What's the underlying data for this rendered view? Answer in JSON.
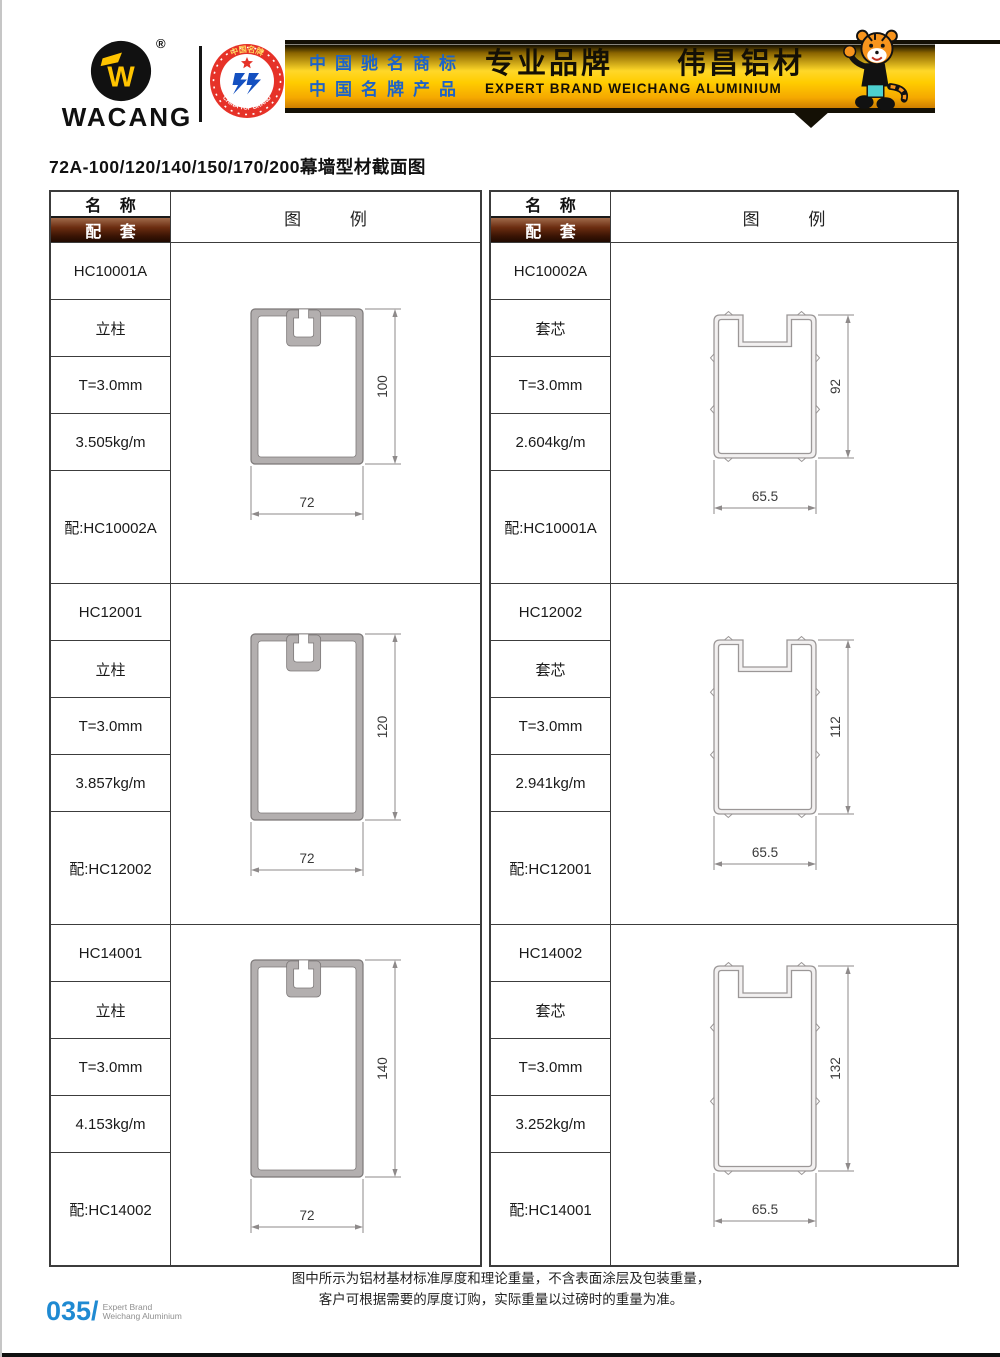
{
  "header": {
    "logo_text": "WACANG",
    "registered_mark": "®",
    "badge": {
      "arc_top": "中国名牌",
      "arc_bottom": "CHINA TOP BRAND"
    },
    "banner": {
      "left_line1": "中国驰名商标",
      "left_line2": "中国名牌产品",
      "right_title": "专业品牌　　伟昌铝材",
      "right_subtitle": "EXPERT BRAND WEICHANG ALUMINIUM"
    }
  },
  "page_title": "72A-100/120/140/150/170/200幕墙型材截面图",
  "table": {
    "header": {
      "name_label": "名 称",
      "match_label": "配 套",
      "legend_label": "图 例"
    },
    "left_sections": [
      {
        "code": "HC10001A",
        "type": "立柱",
        "thickness": "T=3.0mm",
        "weight": "3.505kg/m",
        "match": "配:HC10002A",
        "width_mm": 72,
        "height_mm": 100,
        "width_label": "72",
        "height_label": "100"
      },
      {
        "code": "HC12001",
        "type": "立柱",
        "thickness": "T=3.0mm",
        "weight": "3.857kg/m",
        "match": "配:HC12002",
        "width_mm": 72,
        "height_mm": 120,
        "width_label": "72",
        "height_label": "120"
      },
      {
        "code": "HC14001",
        "type": "立柱",
        "thickness": "T=3.0mm",
        "weight": "4.153kg/m",
        "match": "配:HC14002",
        "width_mm": 72,
        "height_mm": 140,
        "width_label": "72",
        "height_label": "140"
      }
    ],
    "right_sections": [
      {
        "code": "HC10002A",
        "type": "套芯",
        "thickness": "T=3.0mm",
        "weight": "2.604kg/m",
        "match": "配:HC10001A",
        "width_mm": 65.5,
        "height_mm": 92,
        "width_label": "65.5",
        "height_label": "92"
      },
      {
        "code": "HC12002",
        "type": "套芯",
        "thickness": "T=3.0mm",
        "weight": "2.941kg/m",
        "match": "配:HC12001",
        "width_mm": 65.5,
        "height_mm": 112,
        "width_label": "65.5",
        "height_label": "112"
      },
      {
        "code": "HC14002",
        "type": "套芯",
        "thickness": "T=3.0mm",
        "weight": "3.252kg/m",
        "match": "配:HC14001",
        "width_mm": 65.5,
        "height_mm": 132,
        "width_label": "65.5",
        "height_label": "132"
      }
    ]
  },
  "footer": {
    "note_line1": "图中所示为铝材基材标准厚度和理论重量，不含表面涂层及包装重量，",
    "note_line2": "客户可根据需要的厚度订购，实际重量以过磅时的重量为准。",
    "page_number": "035/",
    "brand_line1": "Expert Brand",
    "brand_line2": "Weichang Aluminium"
  },
  "colors": {
    "banner_gold": "#ffcc00",
    "banner_blue": "#1d63c8",
    "header_bar_brown": "#5d2410",
    "profile_fill": "#b3afaf",
    "profile_stroke": "#7c7878",
    "sleeve_wall_fill": "#f2f0f0",
    "sleeve_stroke": "#9b9797",
    "dim_stroke": "#8e8a8a",
    "dim_text": "#3a3a3a",
    "page_number_blue": "#1f8ad2"
  }
}
